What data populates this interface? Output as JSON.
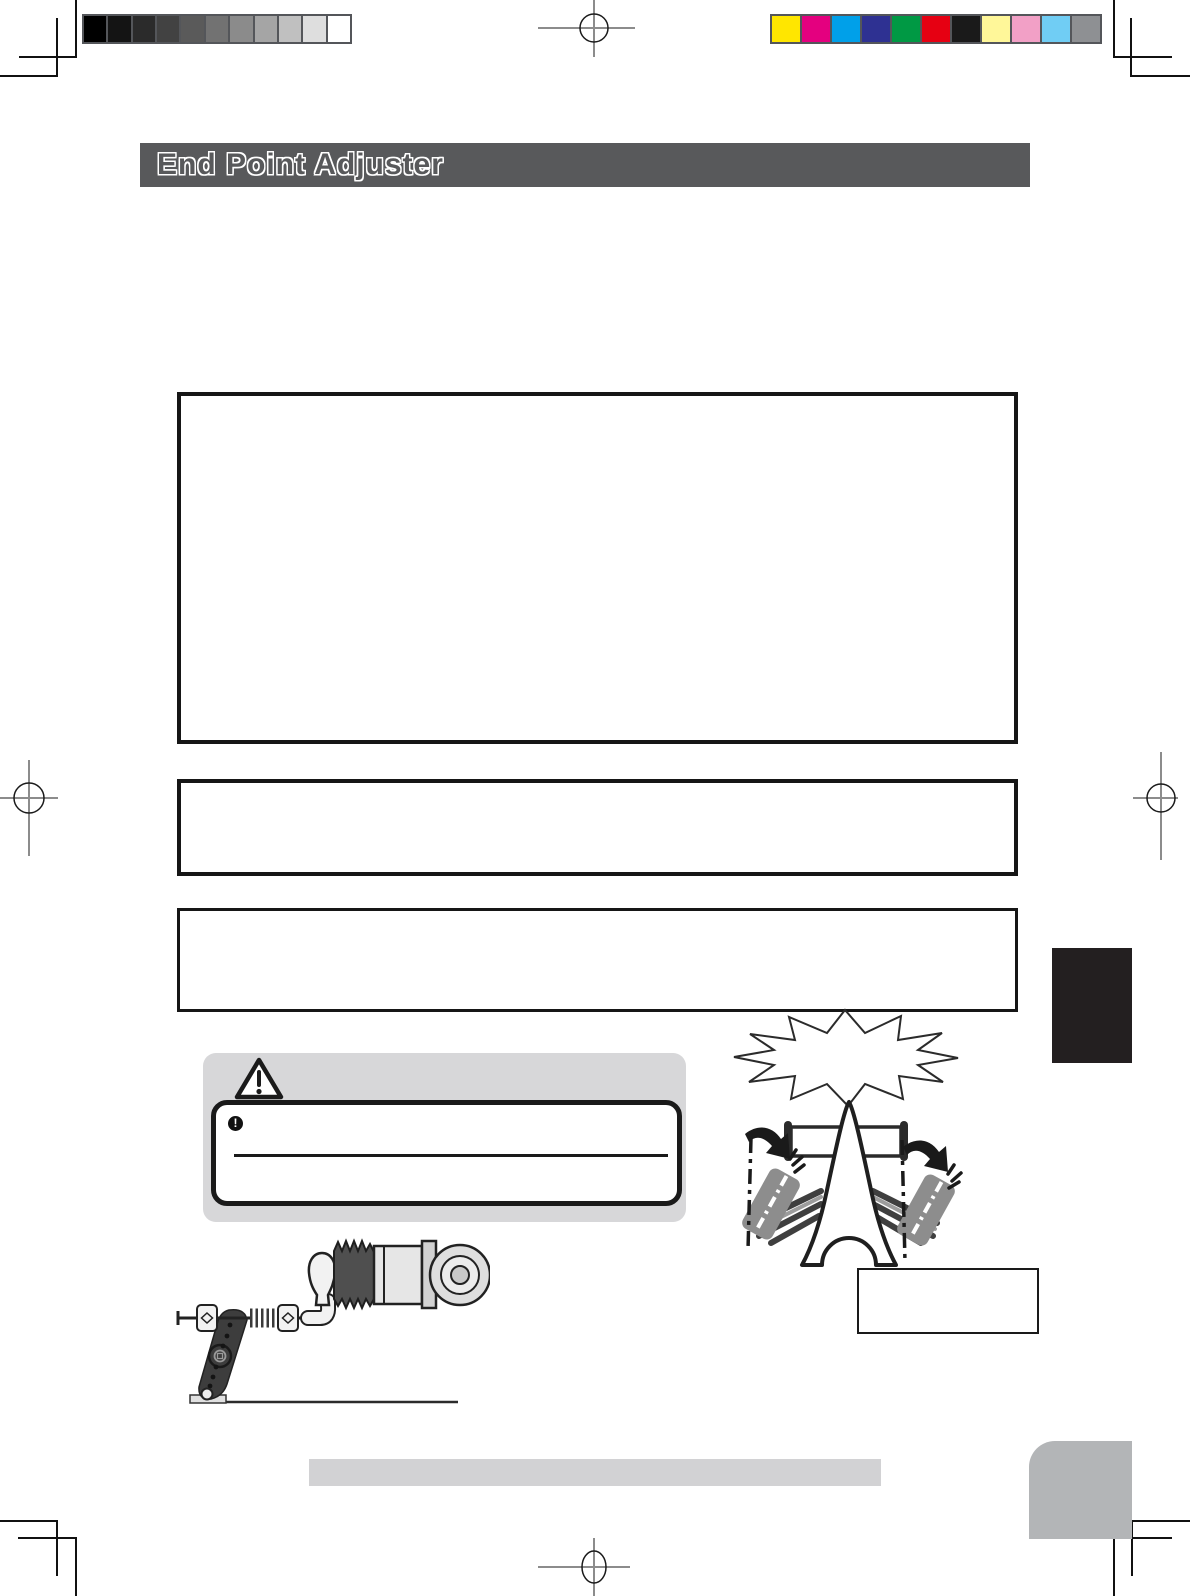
{
  "title_bar": {
    "label": "End Point Adjuster",
    "bg_color": "#58595b"
  },
  "print_calibration": {
    "grayscale_bar": {
      "swatches": [
        "#000000",
        "#141414",
        "#2b2b2b",
        "#424242",
        "#5a5a5a",
        "#727272",
        "#8b8b8b",
        "#a5a5a5",
        "#c0c0c0",
        "#dedede",
        "#ffffff"
      ],
      "border_color": "#54565a"
    },
    "color_bar": {
      "swatches": [
        "#ffe600",
        "#e4007f",
        "#00a0e9",
        "#2e3192",
        "#009944",
        "#e60012",
        "#1a1a1a",
        "#fff799",
        "#f2a0c6",
        "#70cdf4",
        "#8e9093"
      ],
      "border_color": "#54565a"
    }
  },
  "caution": {
    "alert_circle_glyph": "!",
    "panel_bg": "#d7d7d9"
  },
  "accents": {
    "footer_bar_bg": "#d2d2d4",
    "index_tab_color": "#231f20",
    "corner_tab_color": "#b3b5b7",
    "illustration_wheel_gray": "#8d8d8d"
  }
}
